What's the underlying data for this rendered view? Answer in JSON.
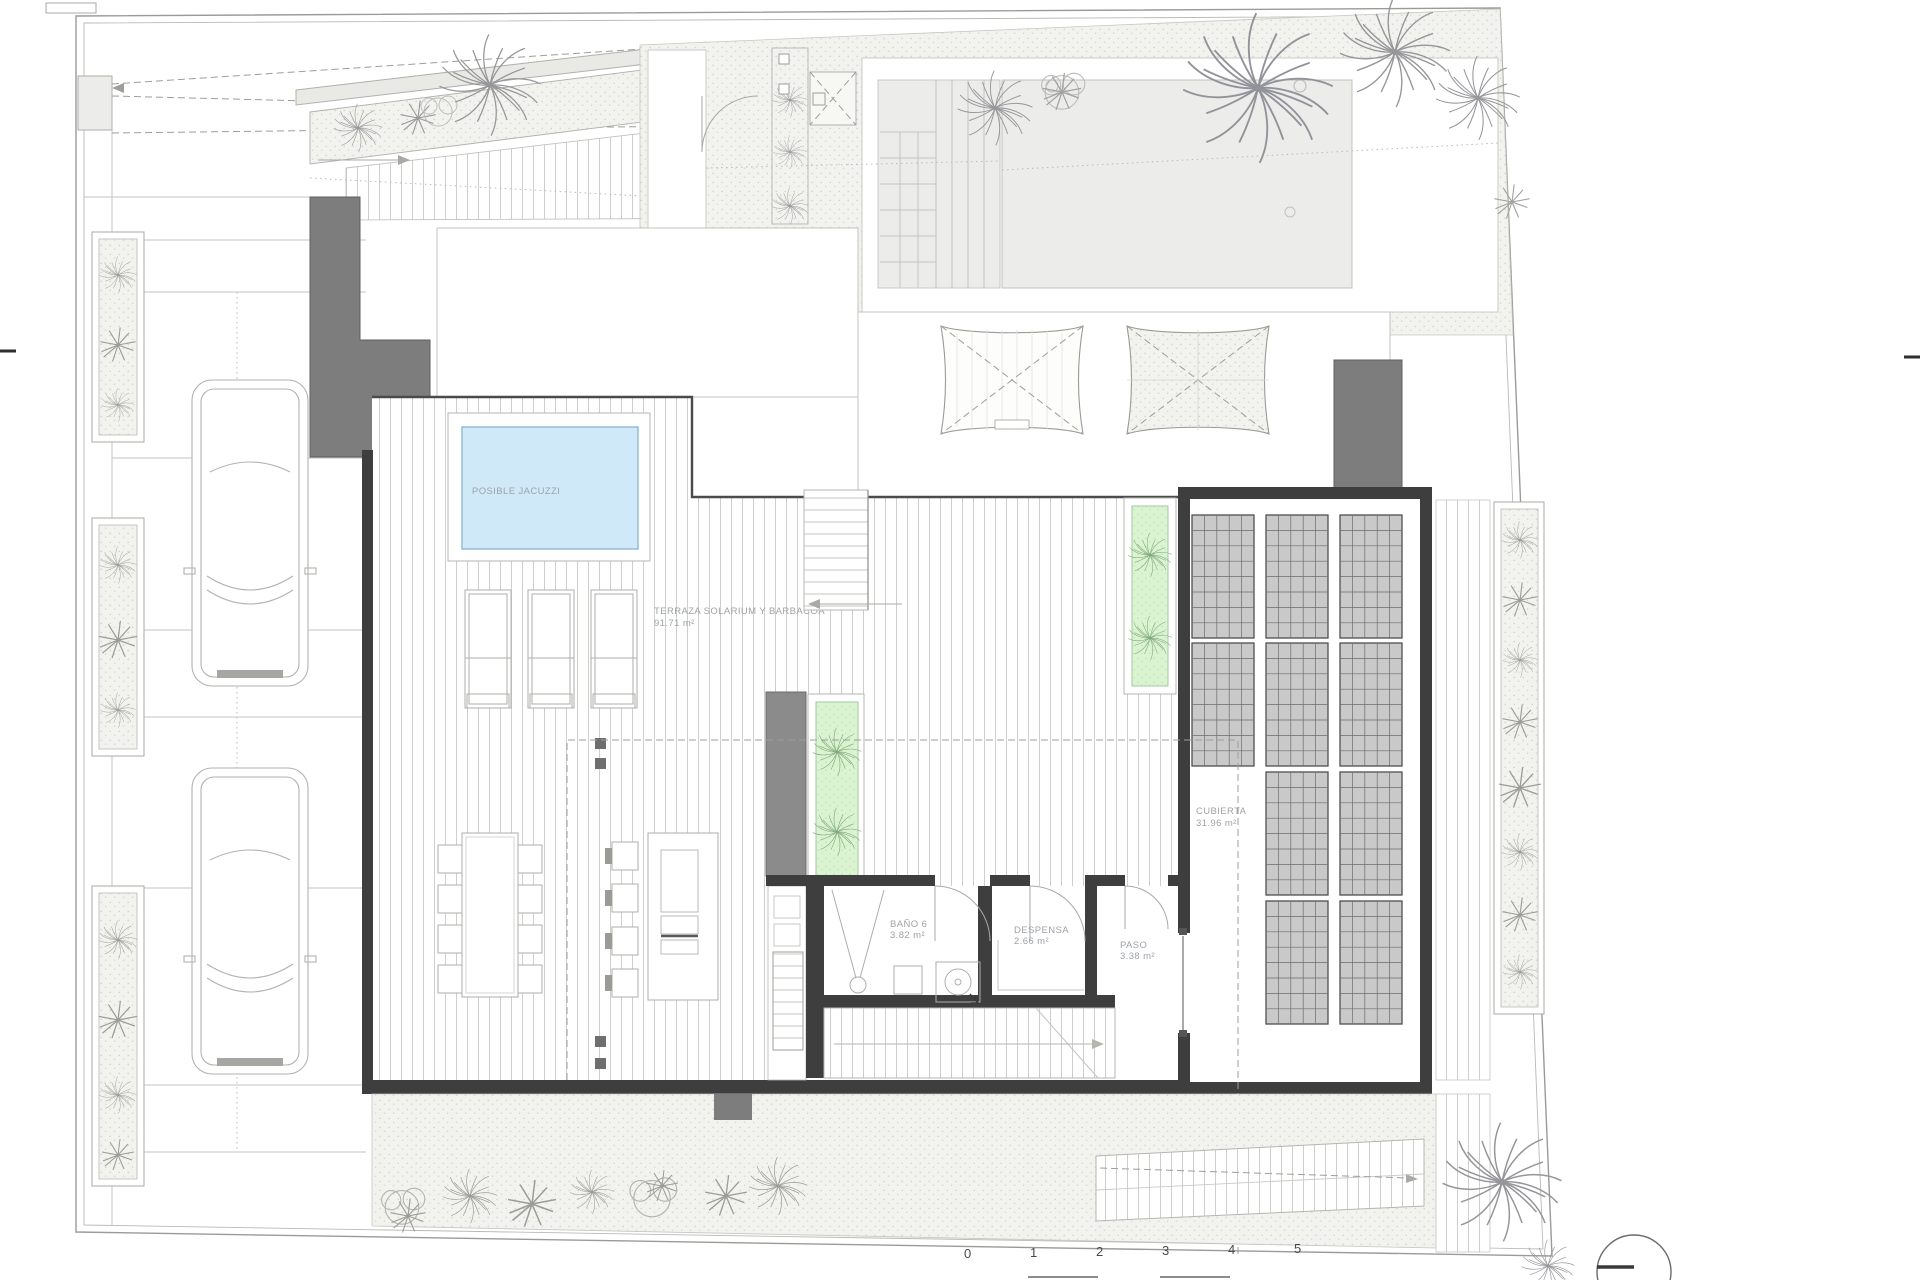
{
  "plan": {
    "type": "architectural-roof-terrace-plan",
    "labels": {
      "jacuzzi": "POSIBLE JACUZZI",
      "terrace_name": "TERRAZA SOLARIUM Y BARBACOA",
      "terrace_area": "91.71 m²",
      "bath_name": "BAÑO 6",
      "bath_area": "3.82 m²",
      "pantry_name": "DESPENSA",
      "pantry_area": "2.66 m²",
      "hall_name": "PASO",
      "hall_area": "3.38 m²",
      "roof_name": "CUBIERTA",
      "roof_area": "31.96 m²"
    },
    "scalebar": {
      "ticks": [
        "0",
        "1",
        "2",
        "3",
        "4",
        "5"
      ]
    },
    "colors": {
      "jacuzzi_fill": "#cfe9f8",
      "jacuzzi_edge": "#8fb8d2",
      "planter_green": "#daf3d0",
      "wall_dark": "#3e3e3e",
      "block_gray": "#7d7d7d",
      "panel_gray": "#c9c9c9",
      "stipple_bg": "#f2f2ee",
      "label_gray": "#9fa3a7"
    },
    "icons": {
      "palm_tree": "palm-tree-icon",
      "shrub": "shrub-icon",
      "bush": "bush-icon",
      "car": "car-top-view",
      "north": "north-circle-icon"
    }
  }
}
